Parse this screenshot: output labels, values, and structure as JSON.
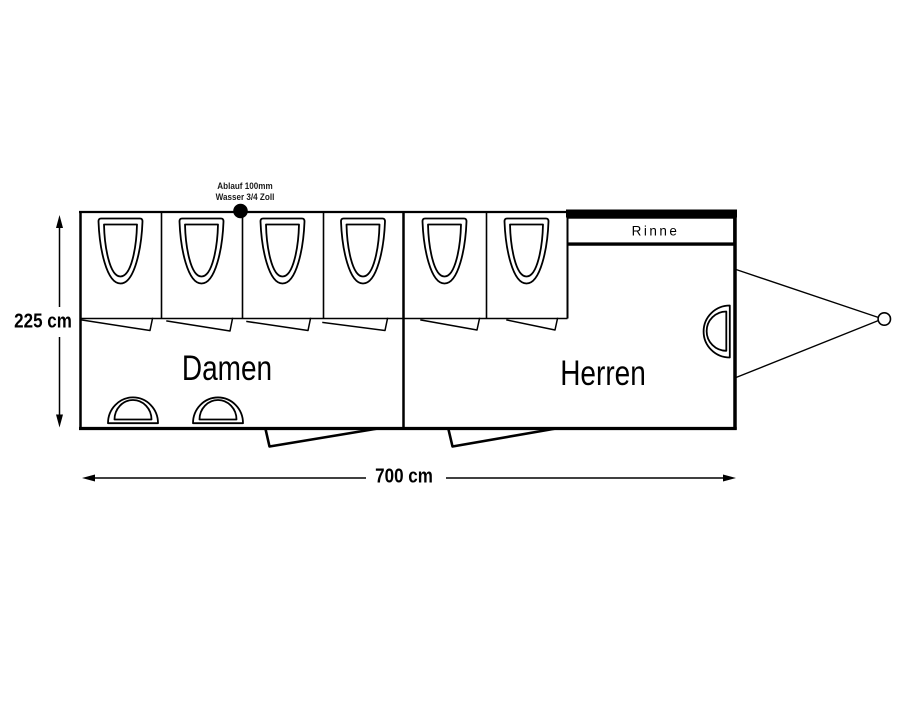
{
  "diagram": {
    "type": "toilet-trailer-floorplan",
    "annotations": {
      "supply_line1": "Ablauf 100mm",
      "supply_line2": "Wasser 3/4 Zoll",
      "rinne_label": "Rinne"
    },
    "rooms": {
      "damen_label": "Damen",
      "herren_label": "Herren"
    },
    "dimensions": {
      "height_label": "225 cm",
      "width_label": "700 cm"
    },
    "fixtures": {
      "toilets_damen": 4,
      "toilets_herren": 2,
      "sinks_damen": 2,
      "sinks_herren": 1,
      "urinal_trough": 1,
      "trailer_hitch": 1
    },
    "colors": {
      "line": "#000000",
      "background": "#ffffff"
    }
  }
}
